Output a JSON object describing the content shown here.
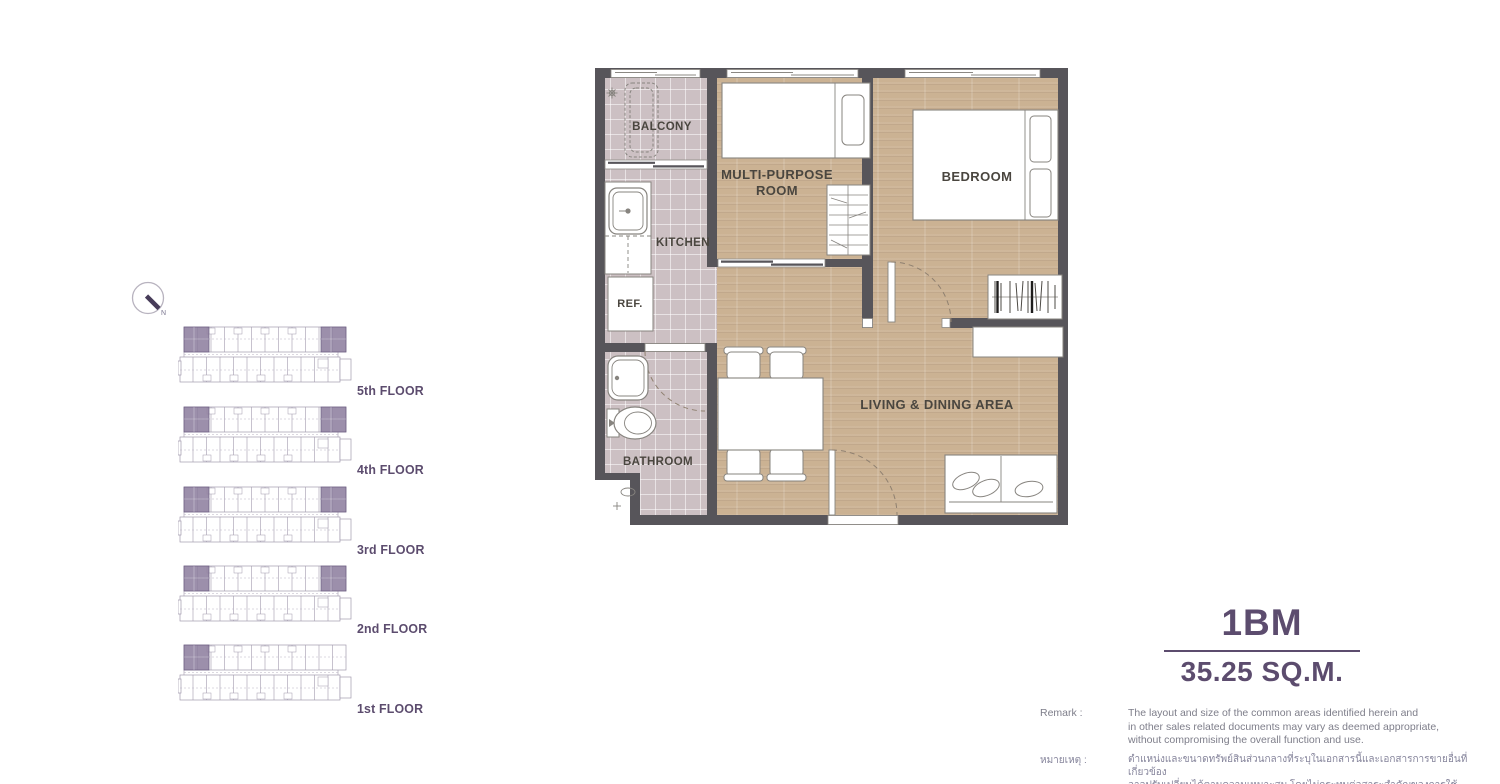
{
  "colors": {
    "accent_purple": "#5c4c6e",
    "highlight_unit_purple": "#8e7f9f",
    "wall_gray": "#57555a",
    "wood_floor": "#cbb293",
    "tile_floor": "#ccc0c3"
  },
  "compass": {
    "north_label": "N"
  },
  "floors": {
    "items": [
      {
        "label": "5th FLOOR"
      },
      {
        "label": "4th FLOOR"
      },
      {
        "label": "3rd FLOOR"
      },
      {
        "label": "2nd FLOOR"
      },
      {
        "label": "1st FLOOR"
      }
    ]
  },
  "plan": {
    "rooms": {
      "balcony": "BALCONY",
      "kitchen": "KITCHEN",
      "ref": "REF.",
      "bathroom": "BATHROOM",
      "multi_purpose": "MULTI-PURPOSE ROOM",
      "bedroom": "BEDROOM",
      "living": "LIVING & DINING AREA"
    }
  },
  "unit": {
    "code": "1BM",
    "area": "35.25 SQ.M."
  },
  "remark": {
    "label_en": "Remark :",
    "en_line1": "The layout and size of the common areas identified herein and",
    "en_line2": "in other sales related documents may vary as deemed appropriate,",
    "en_line3": "without compromising the overall function and use.",
    "label_th": "หมายเหตุ :",
    "th_line1": "ตำแหน่งและขนาดทรัพย์สินส่วนกลางที่ระบุในเอกสารนี้และเอกสารการขายอื่นที่เกี่ยวข้อง",
    "th_line2": "อาจปรับเปลี่ยนได้ตามความเหมาะสม โดยไม่กระทบต่อสาระสำคัญของการใช้งาน"
  }
}
